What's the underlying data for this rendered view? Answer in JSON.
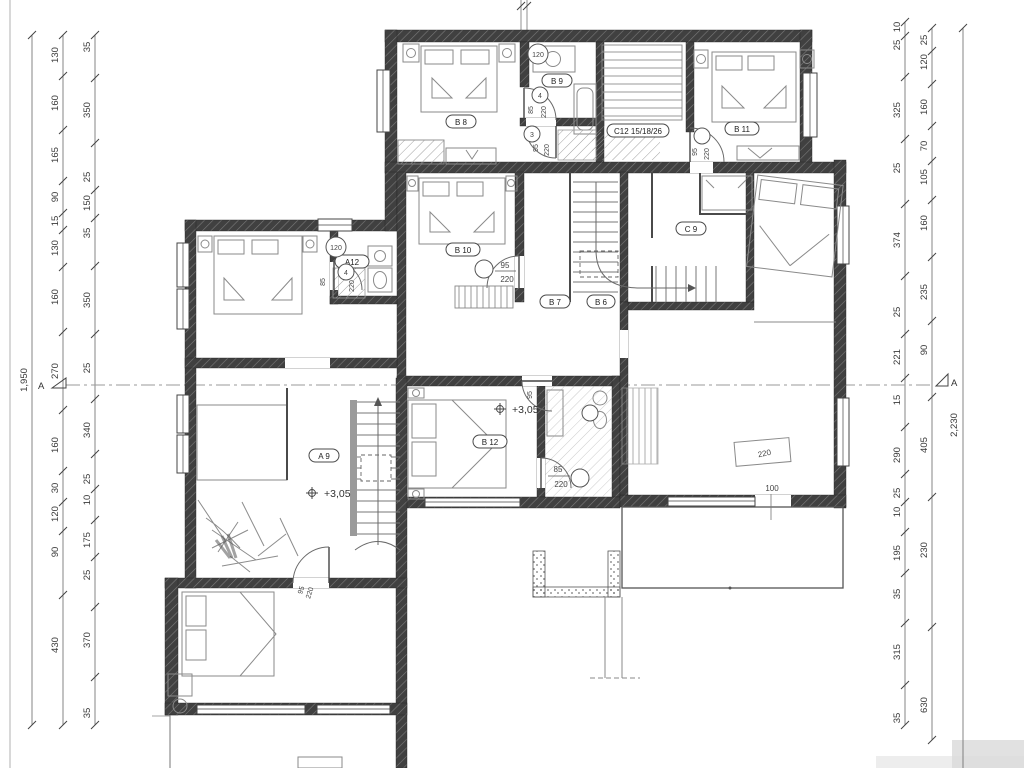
{
  "drawing": {
    "section_marker_left": "A",
    "section_marker_right": "A",
    "elevation_upper": "+3,05",
    "elevation_lower": "+3,05"
  },
  "rooms": {
    "b8": "B 8",
    "b9": "B 9",
    "b10": "B 10",
    "b11": "B 11",
    "b12": "B 12",
    "b7": "B 7",
    "b6": "B 6",
    "c9": "C 9",
    "c12": "C12 15/18/26",
    "a9": "A 9",
    "a12": "A12"
  },
  "doors": {
    "d_b9": {
      "no": "4",
      "w": "85",
      "h": "220"
    },
    "d_hall": {
      "no": "3",
      "w": "95",
      "h": "220"
    },
    "d_b10": {
      "no": "",
      "w": "95",
      "h": "220"
    },
    "d_b11": {
      "no": "",
      "w": "95",
      "h": "220"
    },
    "d_a12": {
      "no": "4",
      "w": "85",
      "h": "220"
    },
    "d_b12_top": {
      "no": "",
      "w": "95",
      "h": "220"
    },
    "d_b12_side": {
      "no": "",
      "w": "85",
      "h": "220"
    },
    "d_a9_room": {
      "no": "",
      "w": "95",
      "h": "220"
    }
  },
  "marks": {
    "vent_top": "120",
    "vent_a12": "120",
    "opening_width": "100",
    "wardrobe_width": "220"
  },
  "dims": {
    "left_outer_total": "1,950",
    "left_mid": [
      "130",
      "160",
      "165",
      "90",
      "15",
      "130",
      "160",
      "270",
      "160",
      "30",
      "120",
      "90",
      "430"
    ],
    "left_inner": [
      "35",
      "350",
      "25",
      "150",
      "35",
      "350",
      "25",
      "340",
      "25",
      "10",
      "175",
      "25",
      "370",
      "35"
    ],
    "right_inner": [
      "10",
      "25",
      "325",
      "25",
      "374",
      "25",
      "221",
      "15",
      "290",
      "25",
      "10",
      "195",
      "35",
      "315",
      "35"
    ],
    "right_mid": [
      "25",
      "120",
      "160",
      "70",
      "105",
      "160",
      "235",
      "90",
      "405",
      "230",
      "630"
    ],
    "right_outer_total": "2,230"
  }
}
